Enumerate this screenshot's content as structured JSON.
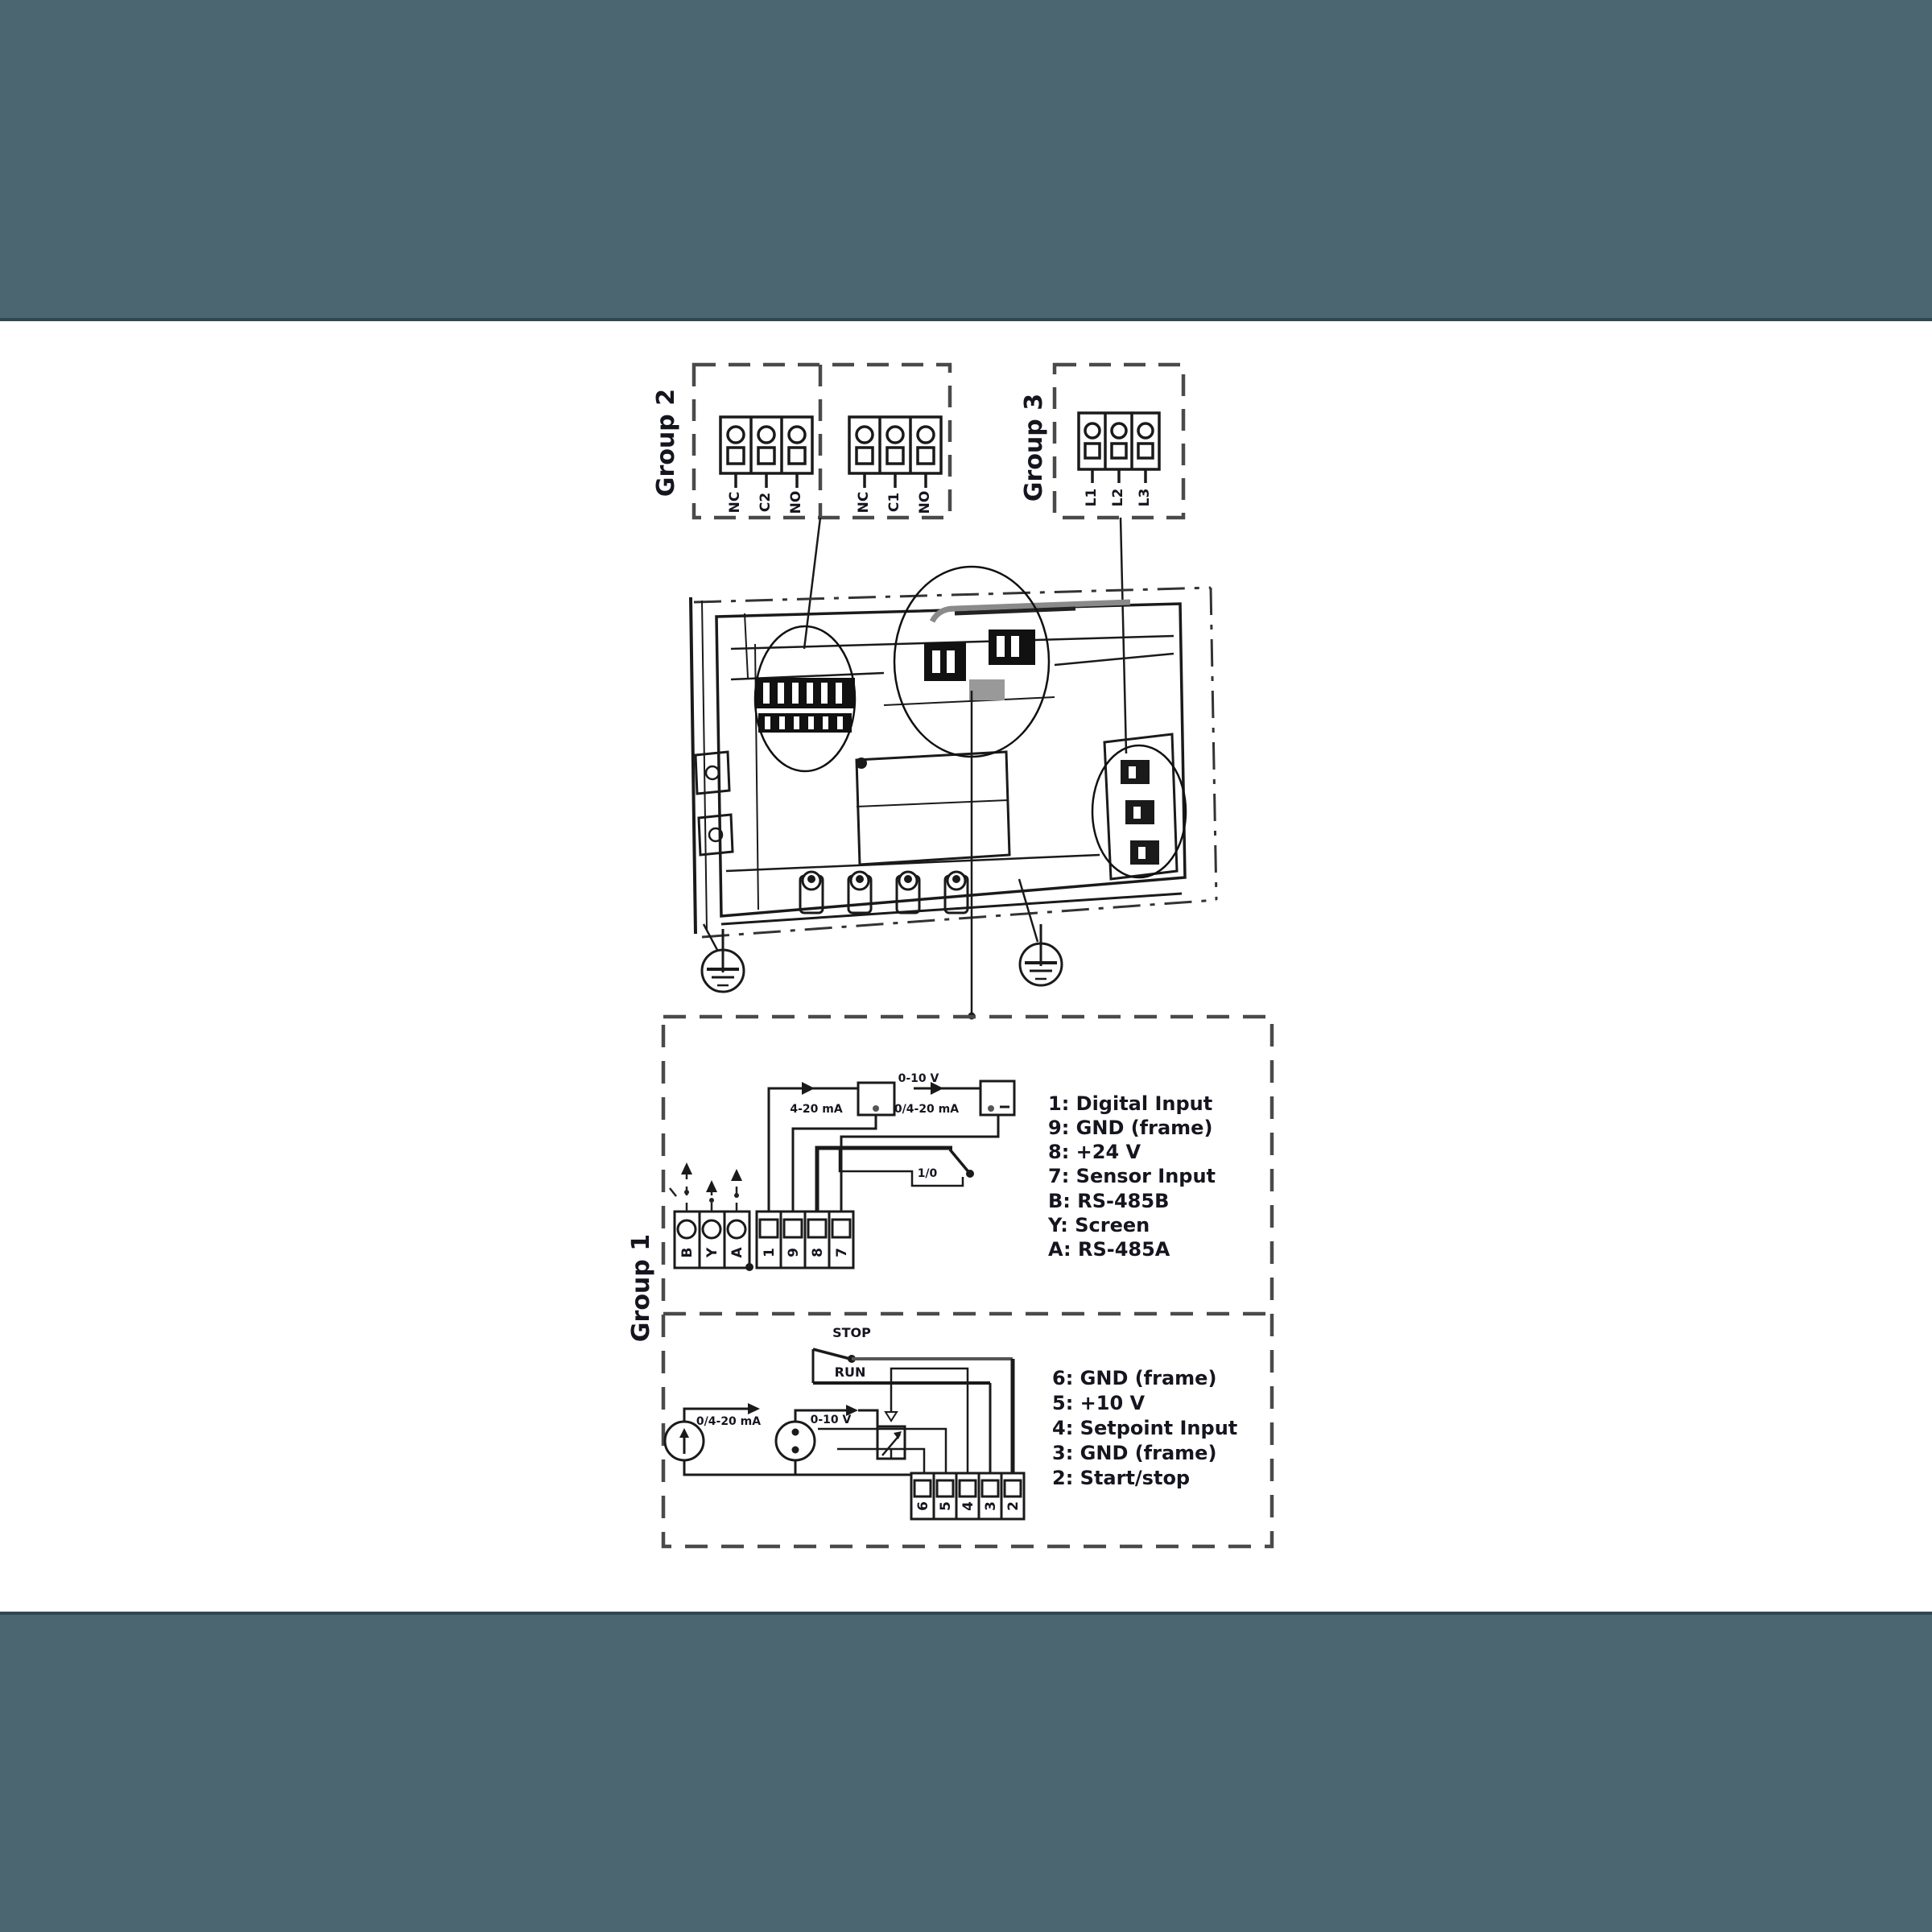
{
  "colors": {
    "band": "#4b6670",
    "band_edge": "#2e4852",
    "line": "#1a1a1a",
    "dash": "#4a4a4a"
  },
  "group2": {
    "label": "Group 2",
    "relay_block_a": [
      "NC",
      "C2",
      "NO"
    ],
    "relay_block_b": [
      "NC",
      "C1",
      "NO"
    ]
  },
  "group3": {
    "label": "Group 3",
    "power_terminals": [
      "L1",
      "L2",
      "L3"
    ]
  },
  "group1": {
    "label": "Group 1",
    "upper": {
      "comm_terminals": [
        "B",
        "Y",
        "A"
      ],
      "io_terminals": [
        "1",
        "9",
        "8",
        "7"
      ],
      "labels": {
        "voltage": "0-10 V",
        "current": "4-20 mA",
        "current_alt": "0/4-20 mA",
        "switch": "1/0"
      },
      "legend": [
        "1: Digital Input",
        "9: GND (frame)",
        "8: +24 V",
        "7: Sensor Input",
        "B: RS-485B",
        "Y: Screen",
        "A: RS-485A"
      ]
    },
    "lower": {
      "terminals": [
        "6",
        "5",
        "4",
        "3",
        "2"
      ],
      "labels": {
        "stop": "STOP",
        "run": "RUN",
        "current": "0/4-20 mA",
        "voltage": "0-10 V"
      },
      "legend": [
        "6: GND (frame)",
        "5: +10 V",
        "4: Setpoint Input",
        "3: GND (frame)",
        "2: Start/stop"
      ]
    }
  }
}
